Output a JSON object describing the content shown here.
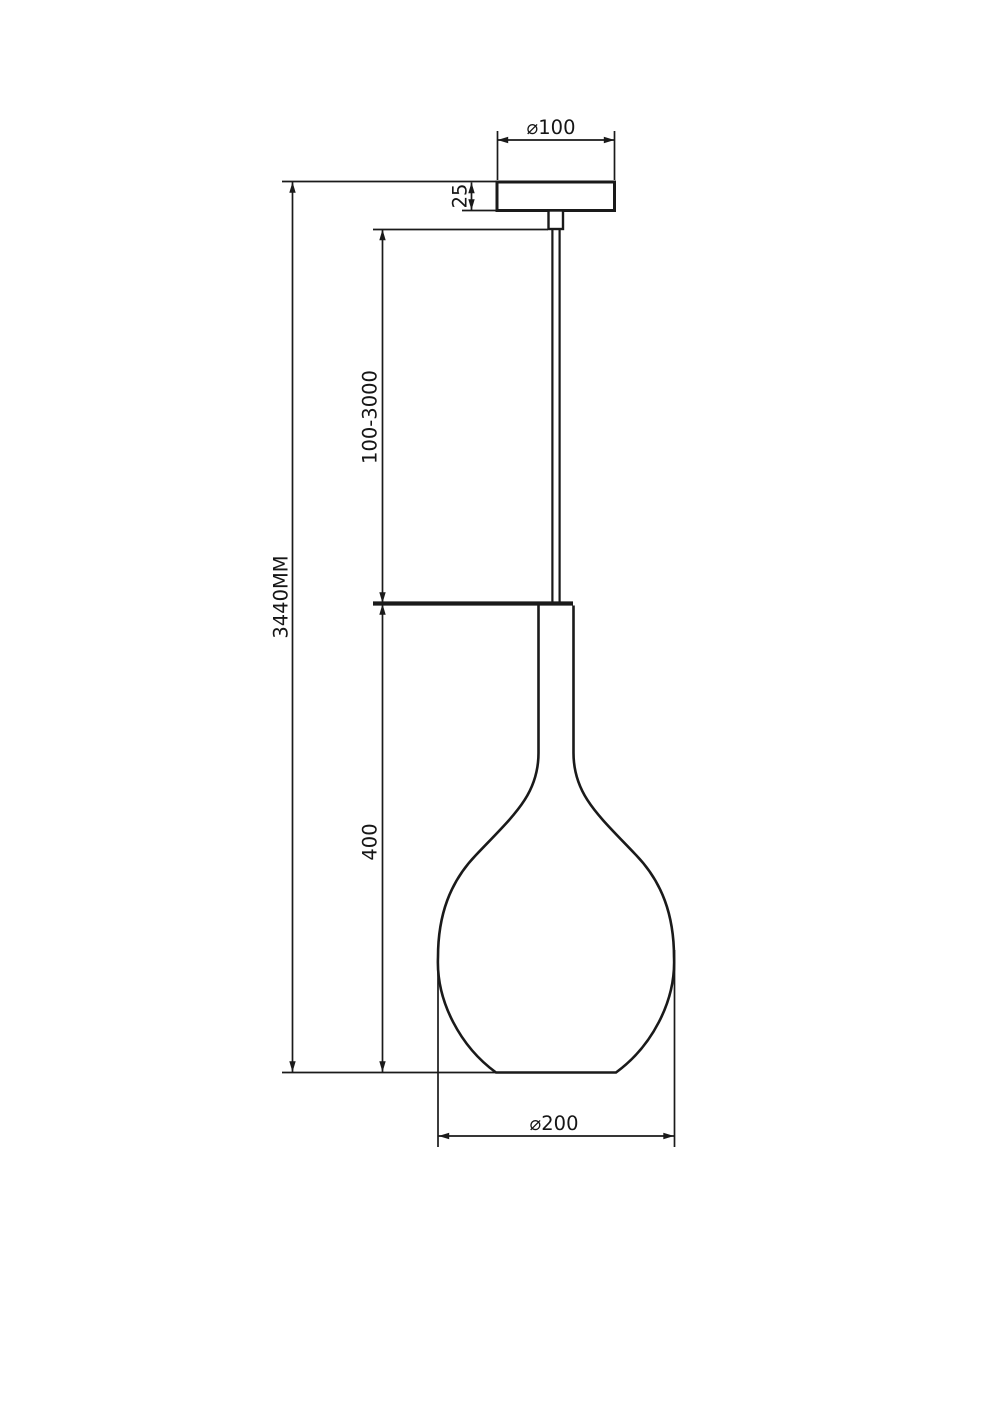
{
  "page": {
    "background": "#ffffff",
    "ink": "#1a1a1a"
  },
  "drawing": {
    "kind": "pendant-lamp-dimension-drawing",
    "labels": {
      "canopy_diameter": "⌀100",
      "canopy_height": "25",
      "suspension_length": "100-3000",
      "total_height": "3440MM",
      "shade_height": "400",
      "shade_diameter": "⌀200"
    }
  }
}
